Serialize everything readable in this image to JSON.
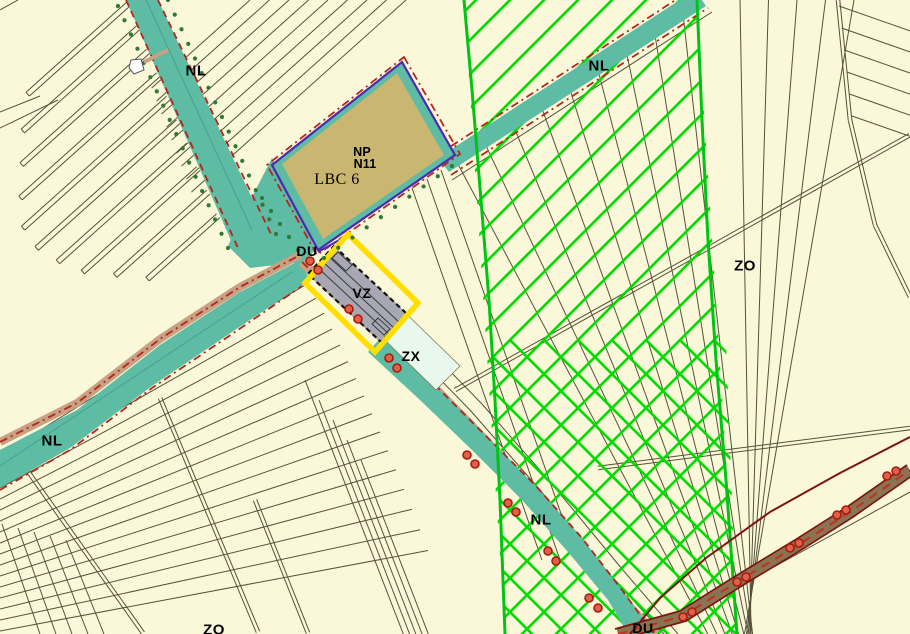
{
  "map": {
    "labels": [
      {
        "id": "nl-north",
        "text": "NL",
        "x": 196,
        "y": 71,
        "cls": "lbl-big"
      },
      {
        "id": "nl-northeast",
        "text": "NL",
        "x": 599,
        "y": 66,
        "cls": "lbl-big"
      },
      {
        "id": "nl-west",
        "text": "NL",
        "x": 52,
        "y": 441,
        "cls": "lbl-big"
      },
      {
        "id": "nl-southeast",
        "text": "NL",
        "x": 541,
        "y": 520,
        "cls": "lbl-big"
      },
      {
        "id": "zo-east",
        "text": "ZO",
        "x": 745,
        "y": 266,
        "cls": "lbl-big"
      },
      {
        "id": "zo-south",
        "text": "ZO",
        "x": 214,
        "y": 630,
        "cls": "lbl-big"
      },
      {
        "id": "du-junction",
        "text": "DU",
        "x": 307,
        "y": 251,
        "cls": ""
      },
      {
        "id": "du-south",
        "text": "DU",
        "x": 643,
        "y": 628,
        "cls": ""
      },
      {
        "id": "vz-zone",
        "text": "VZ",
        "x": 362,
        "y": 293,
        "cls": ""
      },
      {
        "id": "zx-zone",
        "text": "ZX",
        "x": 411,
        "y": 356,
        "cls": ""
      },
      {
        "id": "np-zone",
        "text": "NP",
        "x": 362,
        "y": 152,
        "cls": "lbl-small"
      },
      {
        "id": "n11-zone",
        "text": "N11",
        "x": 365,
        "y": 164,
        "cls": "lbl-small"
      },
      {
        "id": "lbc6-zone",
        "text": "LBC 6",
        "x": 337,
        "y": 180,
        "cls": "lbl-serif"
      }
    ],
    "colors": {
      "cream": "#FBF8D9",
      "teal": "#5EBBA4",
      "tealLine": "#46A18D",
      "khaki": "#C9B671",
      "purple": "#4D28B0",
      "red": "#B3271B",
      "brightRed": "#BE3526",
      "maroon": "#7A150E",
      "roadBrown": "#8A7350",
      "tan": "#C8A185",
      "mint": "#E9F8EC",
      "mintEdge": "#7B7B55",
      "gray": "#A8A8B2",
      "grayDark": "#3A3A44",
      "yellow": "#FFDE00",
      "hatch": "#00DC00",
      "hatchEdge": "#00C414",
      "tree": "#2F7A33",
      "parcel": "#56513A",
      "circleFill": "#E0604A",
      "circleStroke": "#A81A0F",
      "white": "#FFFFFF"
    }
  }
}
